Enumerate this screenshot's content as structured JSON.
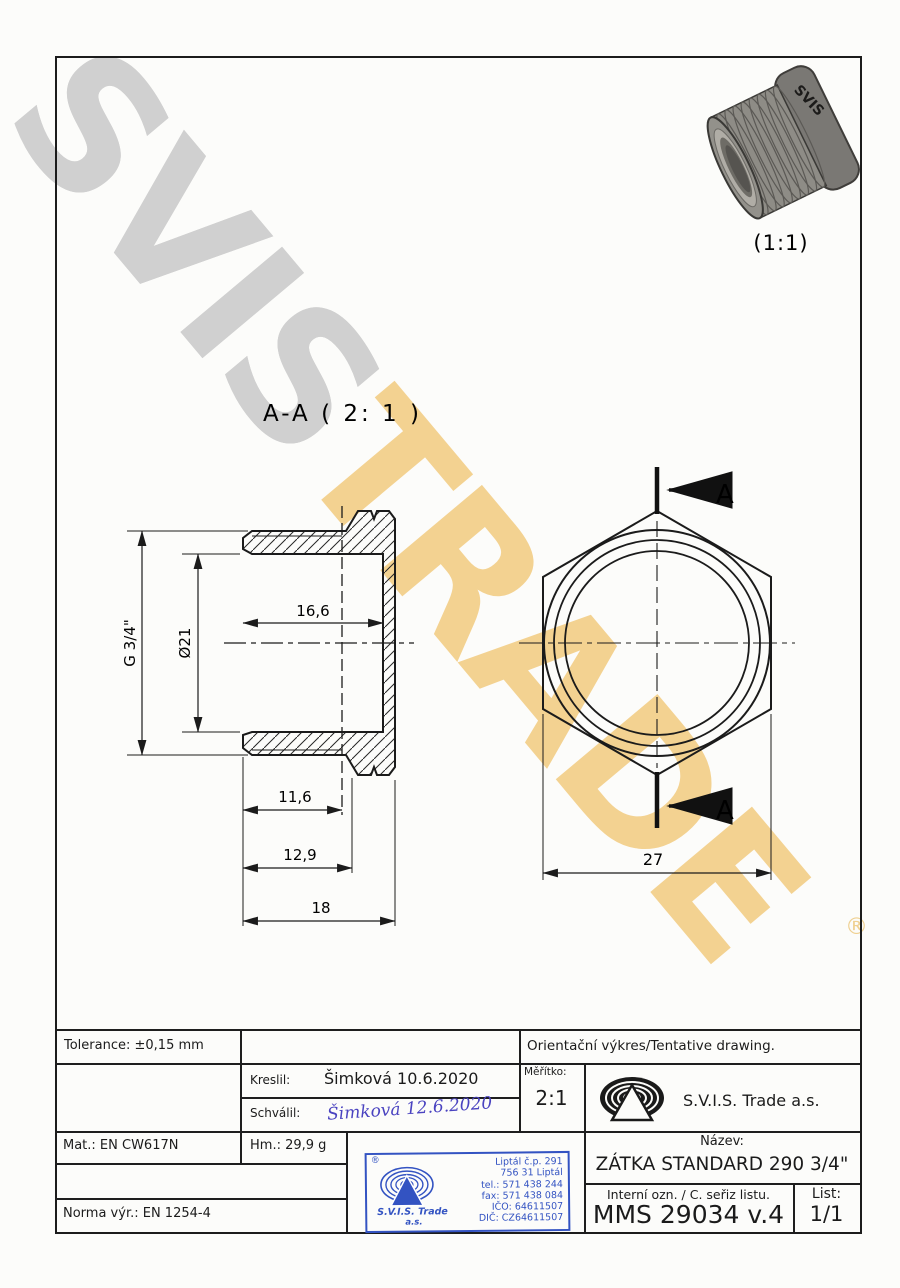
{
  "watermark": {
    "part1": "SVIS",
    "part2": "TRADE",
    "registered": "®"
  },
  "drawing": {
    "section_label": "A-A ( 2: 1 )",
    "photo_scale": "(1:1)",
    "photo_engraving": "SVIS",
    "cut_label_top": "A",
    "cut_label_bottom": "A",
    "dims": {
      "inner_depth": "16,6",
      "inner_diameter": "Ø21",
      "thread": "G 3/4\"",
      "thread_length": "11,6",
      "step_length": "12,9",
      "total_length": "18",
      "across_flats": "27"
    }
  },
  "titleblock": {
    "tolerance": "Tolerance: ±0,15 mm",
    "orientacni": "Orientační výkres/Tentative drawing.",
    "kreslil_label": "Kreslil:",
    "kreslil_value": "Šimková 10.6.2020",
    "schvalil_label": "Schválil:",
    "schvalil_signature": "Šimková 12.6.2020",
    "meritko_label": "Měřítko:",
    "meritko_value": "2:1",
    "company": "S.V.I.S. Trade a.s.",
    "material": "Mat.: EN CW617N",
    "weight": "Hm.: 29,9 g",
    "norma": "Norma výr.: EN 1254-4",
    "nazev_label": "Název:",
    "nazev_value": "ZÁTKA STANDARD 290 3/4\"",
    "interni_label": "Interní ozn. / C. seřiz listu.",
    "interni_value": "MMS 29034 v.4",
    "list_label": "List:",
    "list_value": "1/1"
  },
  "stamp": {
    "registered": "®",
    "company_line1": "S.V.I.S. Trade",
    "company_line2": "a.s.",
    "address_lines": [
      "Liptál č.p. 291",
      "756 31 Liptál",
      "tel.: 571 438 244",
      "fax: 571 438 084",
      "IČO: 64611507",
      "DIČ: CZ64611507"
    ]
  }
}
